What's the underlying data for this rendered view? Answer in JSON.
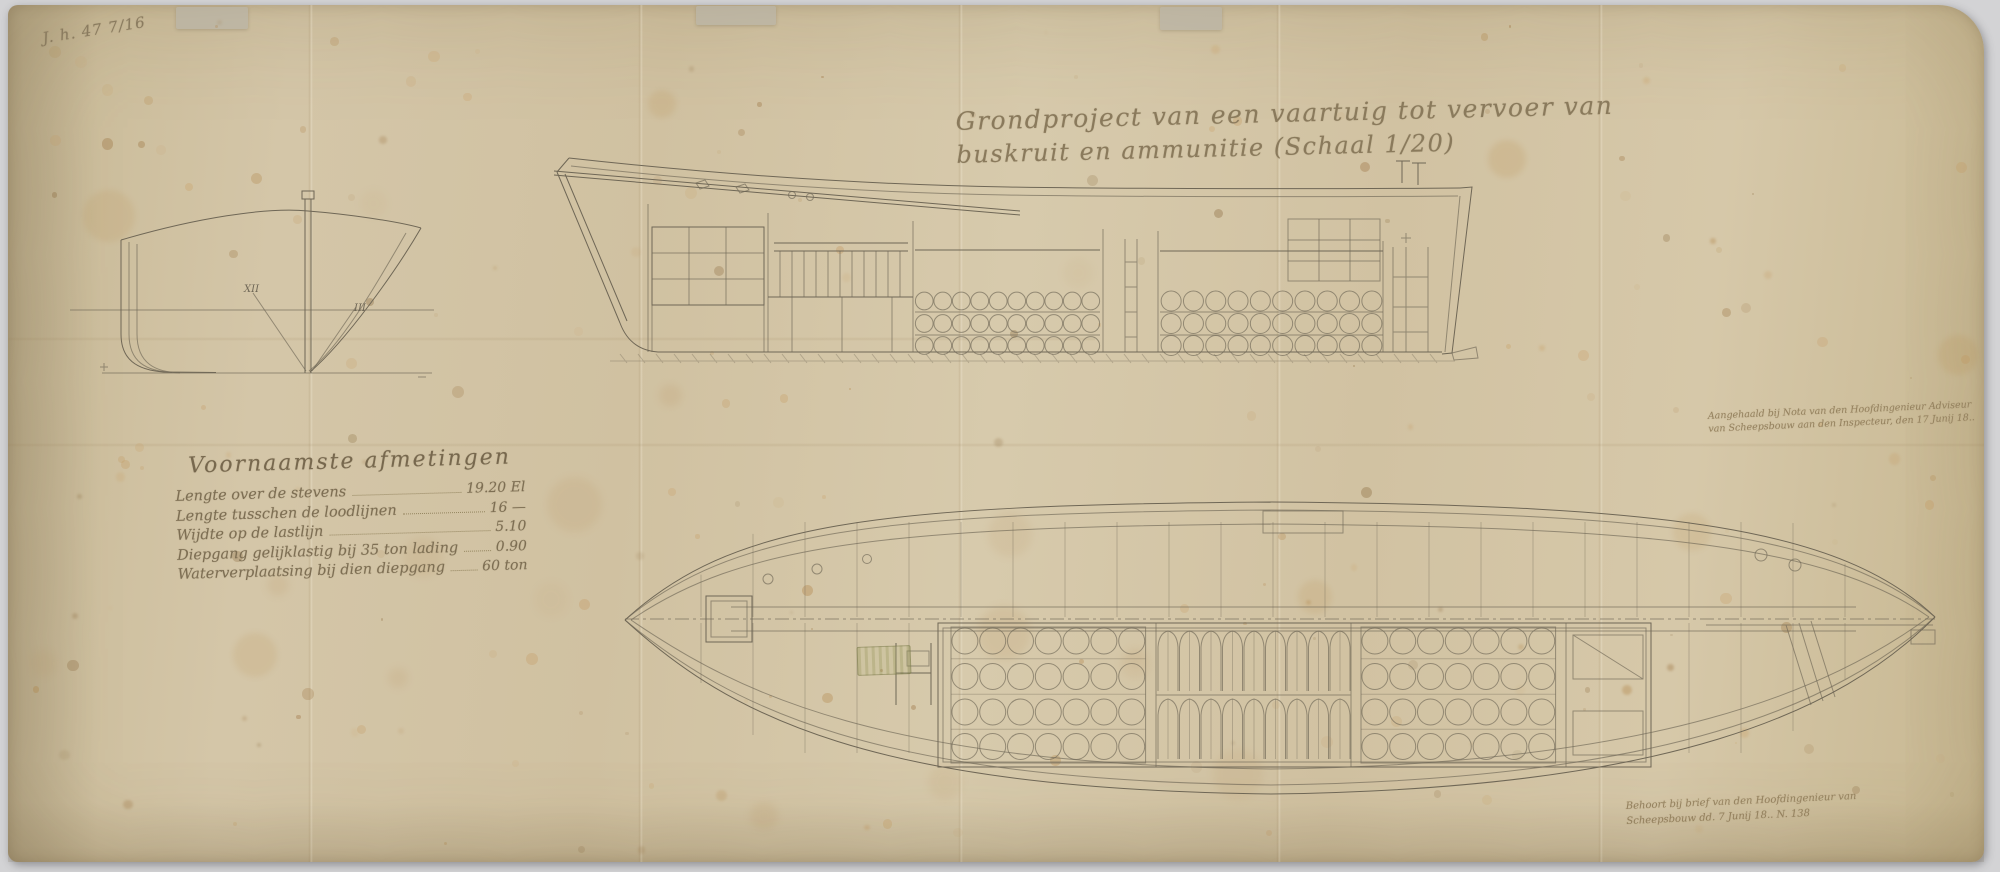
{
  "document": {
    "archival_mark": "J. h. 47 7/16",
    "title": {
      "line1": "Grondproject van een vaartuig tot vervoer van",
      "line2": "buskruit en ammunitie  (Schaal 1/20)"
    },
    "principal_dimensions": {
      "heading": "Voornaamste afmetingen",
      "rows": [
        {
          "label": "Lengte over de stevens",
          "value": "19.20 El"
        },
        {
          "label": "Lengte tusschen de loodlijnen",
          "value": "16 —"
        },
        {
          "label": "Wijdte op de lastlijn",
          "value": "5.10"
        },
        {
          "label": "Diepgang gelijklastig bij 35 ton lading",
          "value": "0.90"
        },
        {
          "label": "Waterverplaatsing bij dien diepgang",
          "value": "60 ton"
        }
      ]
    },
    "annotations": {
      "right_line1": "Aangehaald bij Nota van den Hoofdingenieur Adviseur",
      "right_line2": "van Scheepsbouw aan den Inspecteur, den 17 Junij 18..",
      "bottom_line1": "Behoort bij brief van den Hoofdingenieur van",
      "bottom_line2": "Scheepsbouw dd. 7 Junij 18..  N. 138"
    },
    "frame_labels": {
      "left": "XII",
      "right": "III"
    }
  },
  "colors": {
    "paper": "#d3c5a6",
    "ink": "#6f6756",
    "ink_faint": "#95825f",
    "background": "#d3d3d5",
    "foxing": "#a97f4b"
  }
}
